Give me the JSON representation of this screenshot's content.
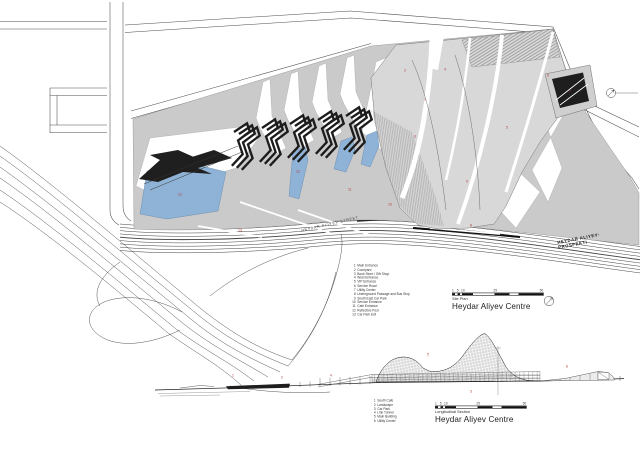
{
  "drawing": {
    "project": "Heydar Aliyev Centre",
    "site_plan": {
      "label": "Site Plan",
      "title": "Heydar Aliyev Centre",
      "scale_ticks": [
        "1",
        "5",
        "10",
        "25",
        "50"
      ],
      "streets": {
        "heydar_aliyev_street": "HEYDAR ALIYEV STREET",
        "prospekti_line1": "HEYDAR ALIYEV-",
        "prospekti_line2": "PROSPEKTI"
      },
      "legend": [
        {
          "num": "1",
          "label": "Main Entrance"
        },
        {
          "num": "2",
          "label": "Courtyard"
        },
        {
          "num": "3",
          "label": "Book Store / Gift Shop"
        },
        {
          "num": "4",
          "label": "West Entrance"
        },
        {
          "num": "5",
          "label": "VIP Entrance"
        },
        {
          "num": "6",
          "label": "Service Road"
        },
        {
          "num": "7",
          "label": "Utility Center"
        },
        {
          "num": "8",
          "label": "Underground Passage and Bus Stop"
        },
        {
          "num": "9",
          "label": "South East Car Park"
        },
        {
          "num": "10",
          "label": "Service Entrance"
        },
        {
          "num": "11",
          "label": "Cafe Entrance"
        },
        {
          "num": "12",
          "label": "Reflective Pool"
        },
        {
          "num": "13",
          "label": "Car Park Exit"
        }
      ],
      "callouts": [
        {
          "n": "2",
          "x": 404,
          "y": 69
        },
        {
          "n": "4",
          "x": 444,
          "y": 68
        },
        {
          "n": "6",
          "x": 547,
          "y": 74
        },
        {
          "n": "1",
          "x": 424,
          "y": 98
        },
        {
          "n": "3",
          "x": 414,
          "y": 135
        },
        {
          "n": "5",
          "x": 506,
          "y": 126
        },
        {
          "n": "7",
          "x": 569,
          "y": 90
        },
        {
          "n": "9",
          "x": 466,
          "y": 180
        },
        {
          "n": "10",
          "x": 388,
          "y": 203
        },
        {
          "n": "11",
          "x": 348,
          "y": 188
        },
        {
          "n": "12",
          "x": 178,
          "y": 193
        },
        {
          "n": "12",
          "x": 296,
          "y": 170
        },
        {
          "n": "13",
          "x": 238,
          "y": 229
        },
        {
          "n": "8",
          "x": 470,
          "y": 224
        }
      ]
    },
    "section": {
      "label": "Longitudinal Section",
      "title": "Heydar Aliyev Centre",
      "scale_ticks": [
        "1",
        "5",
        "10",
        "25",
        "50"
      ],
      "legend": [
        {
          "num": "1",
          "label": "South Cafe"
        },
        {
          "num": "2",
          "label": "Landscape"
        },
        {
          "num": "3",
          "label": "Car Park"
        },
        {
          "num": "4",
          "label": "Link Tunnel"
        },
        {
          "num": "5",
          "label": "Main Building"
        },
        {
          "num": "6",
          "label": "Utility Center"
        }
      ],
      "callouts": [
        {
          "n": "1",
          "x": 232,
          "y": 374
        },
        {
          "n": "2",
          "x": 281,
          "y": 376
        },
        {
          "n": "4",
          "x": 330,
          "y": 374
        },
        {
          "n": "5",
          "x": 427,
          "y": 353
        },
        {
          "n": "3",
          "x": 470,
          "y": 390
        },
        {
          "n": "6",
          "x": 566,
          "y": 365
        }
      ]
    },
    "colors": {
      "pool": "#8fb3d6",
      "plaza": "#cacaca",
      "callout": "#b03a3a",
      "ink": "#1c1c1c"
    }
  }
}
